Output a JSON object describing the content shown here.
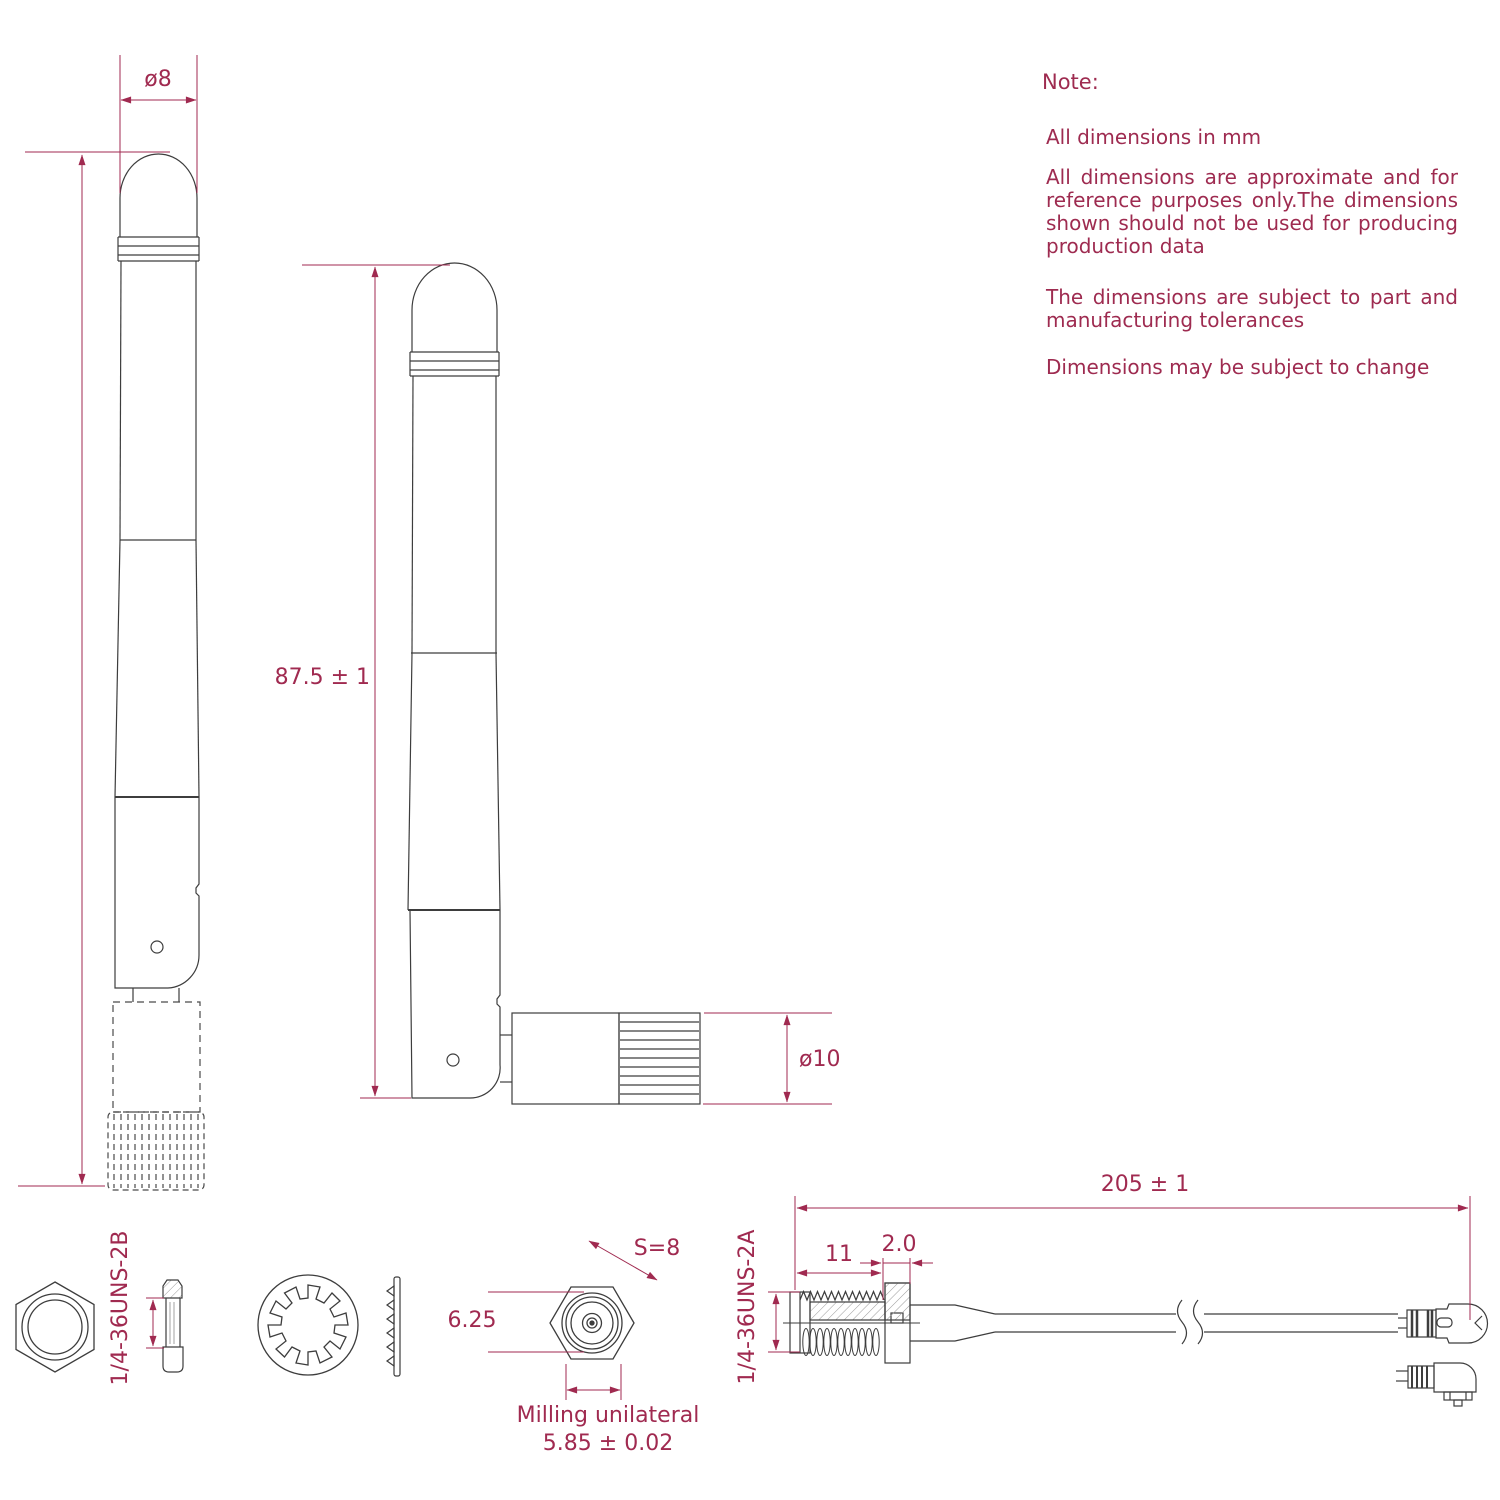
{
  "notes": {
    "heading": "Note:",
    "items": [
      "All dimensions in mm",
      "All dimensions are approximate and for reference purposes only.The dimensions shown should not be used for producing production data",
      "The dimensions are subject to part and manufacturing  tolerances",
      "Dimensions may be subject to change"
    ]
  },
  "dimensions": {
    "tip_diameter": "ø8",
    "antenna_length": "87.5 ± 1",
    "connector_diameter": "ø10",
    "hex_across_flats": "S=8",
    "connector_face_diameter": "6.25",
    "milling_note": "Milling unilateral",
    "milling_width": "5.85 ± 0.02",
    "cable_length": "205 ± 1",
    "thread_length": "11",
    "bulkhead_step": "2.0",
    "nut_thread_spec": "1/4-36UNS-2B",
    "jack_thread_spec": "1/4-36UNS-2A"
  },
  "colors": {
    "dimension_accent": "#a02a50",
    "part_line": "#3d3d3d",
    "background": "#ffffff"
  }
}
